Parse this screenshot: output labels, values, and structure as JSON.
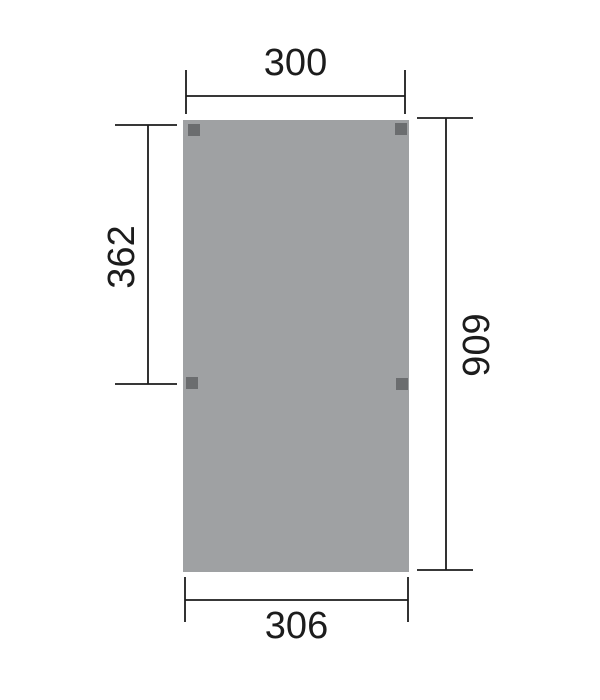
{
  "colors": {
    "panel": "#9fa1a3",
    "post": "#6b6d6f",
    "line": "#1c1c1c"
  },
  "dimensions": {
    "top": "300",
    "left": "362",
    "right": "606",
    "bottom": "306"
  }
}
